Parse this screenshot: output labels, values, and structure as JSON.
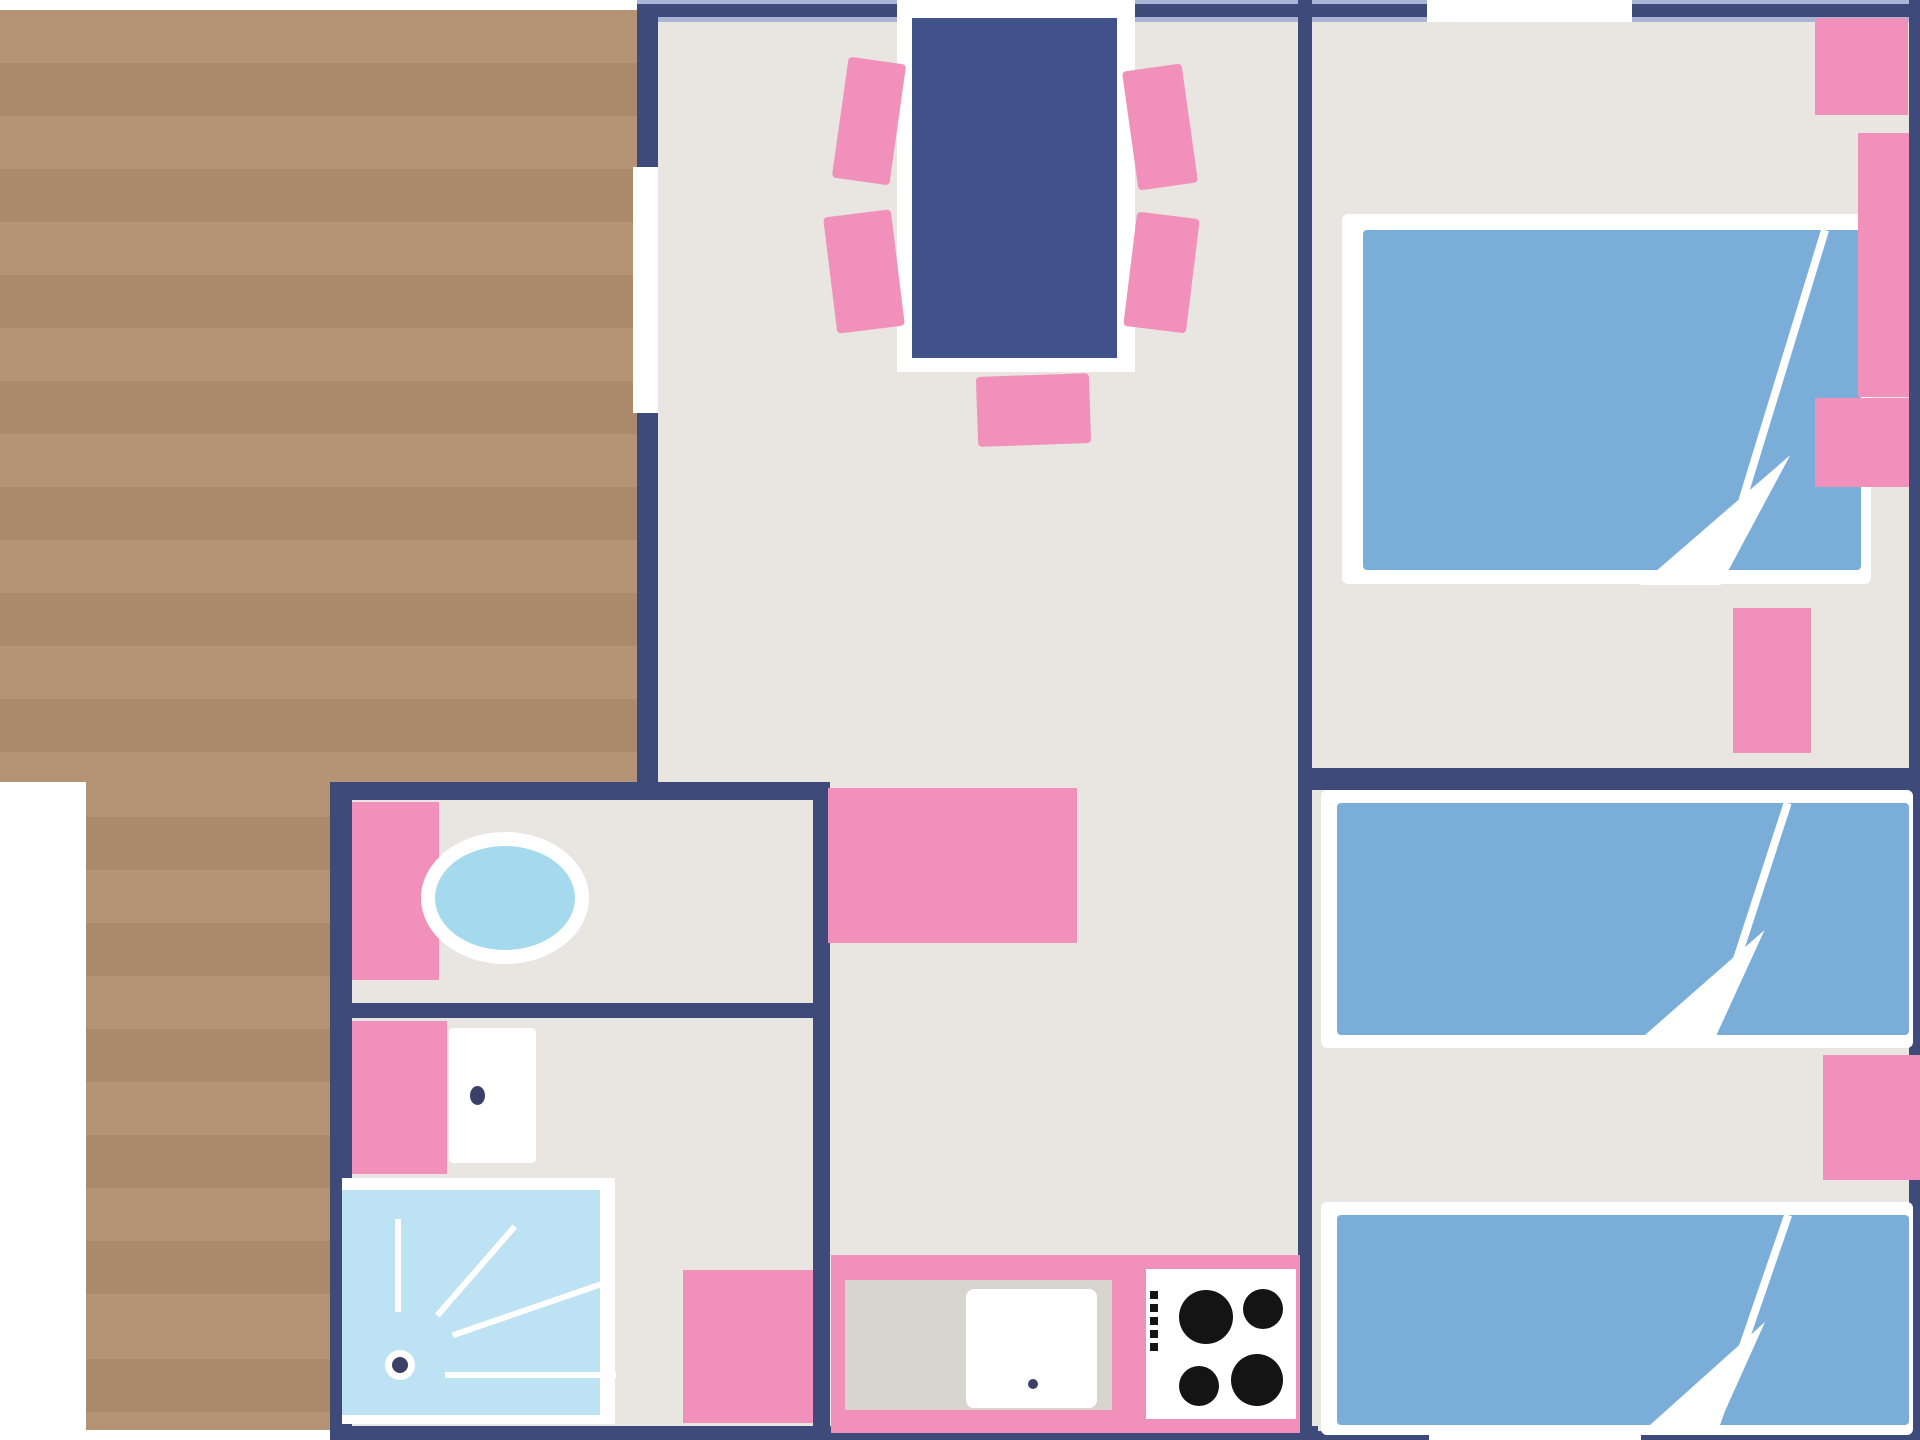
{
  "page": {
    "type": "floor-plan",
    "description": "mobile home / holiday cottage floor plan, top-down schematic"
  },
  "colors": {
    "white": "#ffffff",
    "floor": "#e9e5e1",
    "deck_light": "#b49475",
    "deck_dark": "#aa8a6b",
    "wall": "#3e4a7a",
    "wall_highlight": "#aab4d6",
    "pink": "#f191bb",
    "table_blue": "#41528a",
    "bed_blue": "#7aaed9",
    "shower_blue": "#bce2f3",
    "sink_blue": "#a5daee",
    "counter_grey": "#d8d4ce",
    "burner_black": "#141414",
    "dot_navy": "#3a4066"
  },
  "rooms": [
    {
      "name": "terrace-deck"
    },
    {
      "name": "living-dining-area"
    },
    {
      "name": "bedroom-double"
    },
    {
      "name": "bedroom-twin"
    },
    {
      "name": "washbasin-room"
    },
    {
      "name": "wc-shower-room"
    },
    {
      "name": "kitchen"
    },
    {
      "name": "hallway"
    }
  ],
  "furniture": [
    {
      "name": "dining-table",
      "room": "living-dining-area"
    },
    {
      "name": "dining-chair",
      "room": "living-dining-area",
      "count": 5
    },
    {
      "name": "bench-sofa",
      "room": "living-dining-area"
    },
    {
      "name": "double-bed",
      "room": "bedroom-double"
    },
    {
      "name": "wardrobe-shelf-block",
      "room": "bedroom-double",
      "count": 4
    },
    {
      "name": "single-bed",
      "room": "bedroom-twin",
      "count": 2
    },
    {
      "name": "nightstand",
      "room": "bedroom-twin"
    },
    {
      "name": "washbasin",
      "room": "washbasin-room"
    },
    {
      "name": "toilet",
      "room": "wc-shower-room"
    },
    {
      "name": "shower-tray",
      "room": "wc-shower-room"
    },
    {
      "name": "kitchen-counter",
      "room": "kitchen"
    },
    {
      "name": "kitchen-sink",
      "room": "kitchen"
    },
    {
      "name": "hob-four-burners",
      "room": "kitchen"
    },
    {
      "name": "storage-unit",
      "room": "hallway"
    }
  ],
  "openings": [
    {
      "name": "terrace-door",
      "wall": "living-left"
    },
    {
      "name": "dining-window",
      "wall": "top"
    },
    {
      "name": "bedroom-double-window",
      "wall": "top"
    },
    {
      "name": "bedroom-twin-window",
      "wall": "bottom"
    }
  ]
}
